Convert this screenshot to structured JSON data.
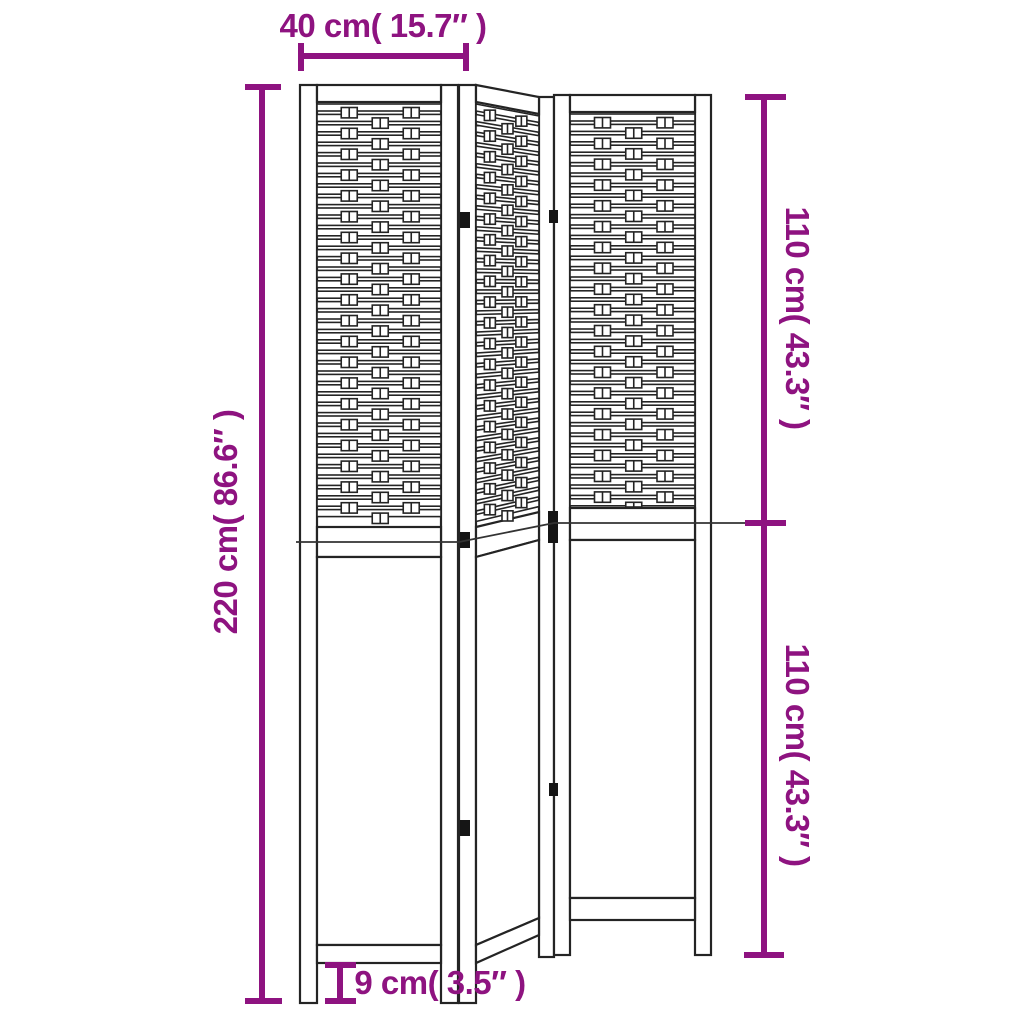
{
  "colors": {
    "background": "#ffffff",
    "accent": "#8E1380",
    "line": "#242424"
  },
  "labels": {
    "width_top": "40 cm( 15.7″ )",
    "height_total": "220 cm( 86.6″ )",
    "height_upper": "110 cm( 43.3″ )",
    "height_lower": "110 cm( 43.3″ )",
    "foot_height": "9 cm( 3.5″ )"
  },
  "dimensions_data": {
    "panel_count": 3,
    "panel_width_cm": 40,
    "panel_width_in": 15.7,
    "total_height_cm": 220,
    "total_height_in": 86.6,
    "upper_section_height_cm": 110,
    "upper_section_height_in": 43.3,
    "lower_section_height_cm": 110,
    "lower_section_height_in": 43.3,
    "foot_height_cm": 9,
    "foot_height_in": 3.5
  }
}
